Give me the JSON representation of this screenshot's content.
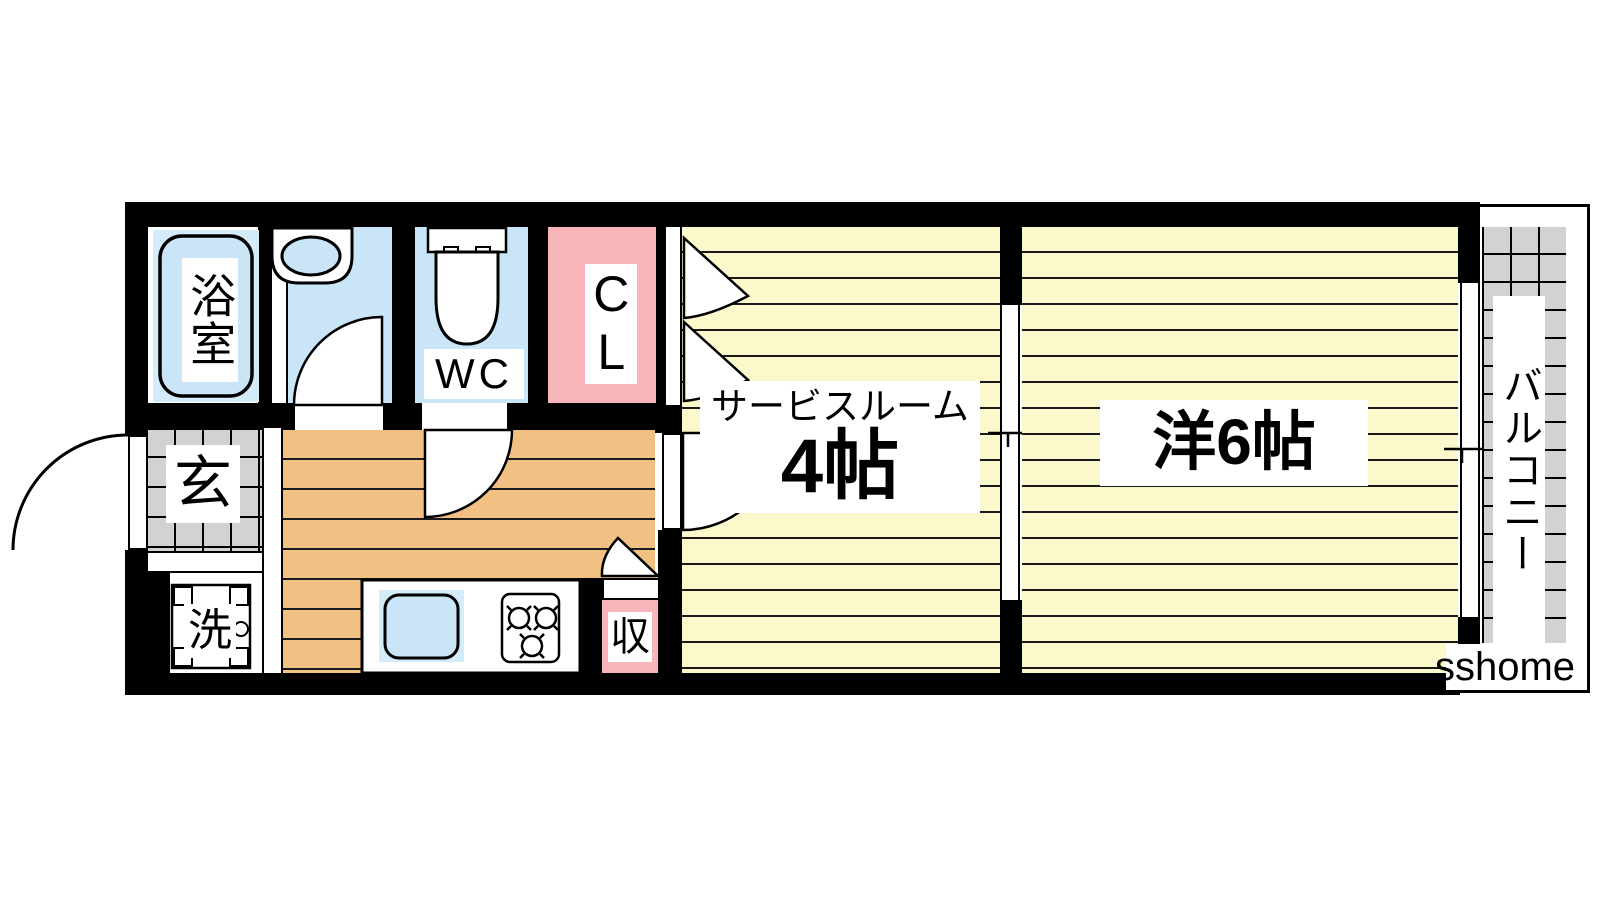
{
  "plan": {
    "watermark": "sshome",
    "rooms": {
      "bath": {
        "label": "浴室"
      },
      "toilet": {
        "label": "WC"
      },
      "closet": {
        "label": "CL"
      },
      "service_room": {
        "label_name": "サービスルーム",
        "label_size": "4帖"
      },
      "western_room": {
        "label": "洋6帖"
      },
      "balcony": {
        "label": "バルコニー"
      },
      "entrance": {
        "label": "玄"
      },
      "laundry": {
        "label": "洗"
      },
      "storage": {
        "label": "収"
      }
    },
    "colors": {
      "wall": "#000000",
      "wet_area_blue": "#C9E5F7",
      "closet_pink": "#F7B5B9",
      "room_yellow": "#FBF8CB",
      "kitchen_tan": "#F0C183",
      "tile_gray": "#D2D2D2"
    }
  }
}
